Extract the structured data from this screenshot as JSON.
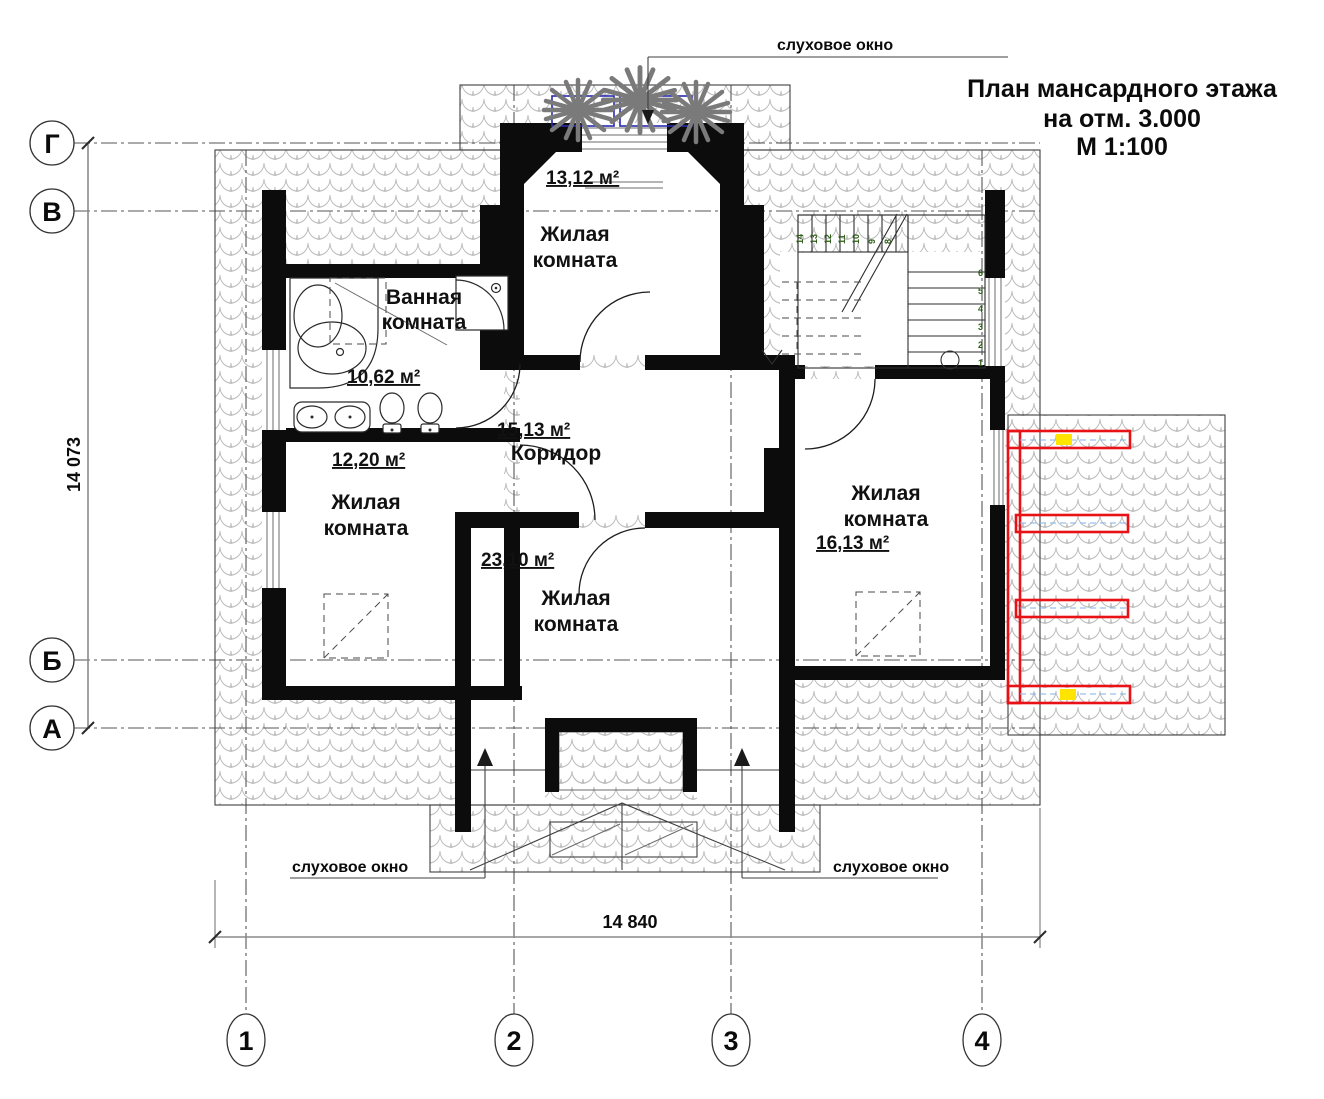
{
  "title": {
    "line1": "План мансардного этажа",
    "line2": "на отм. 3.000",
    "line3": "М 1:100"
  },
  "axes": {
    "horizontal": [
      "Г",
      "В",
      "Б",
      "А"
    ],
    "vertical": [
      "1",
      "2",
      "3",
      "4"
    ]
  },
  "dimensions": {
    "left_vertical": "14 073",
    "bottom_horizontal": "14 840"
  },
  "rooms": [
    {
      "name1": "Жилая",
      "name2": "комната",
      "area": "13,12 м²"
    },
    {
      "name1": "Ванная",
      "name2": "комната",
      "area": "10,62 м²"
    },
    {
      "name1": "Жилая",
      "name2": "комната",
      "area": "12,20 м²"
    },
    {
      "name1": "Коридор",
      "area": "15,13 м²"
    },
    {
      "name1": "Жилая",
      "name2": "комната",
      "area": "23,10 м²"
    },
    {
      "name1": "Жилая",
      "name2": "комната",
      "area": "16,13 м²"
    }
  ],
  "annotations": {
    "dormer_top": "слуховое окно",
    "dormer_bottom_left": "слуховое окно",
    "dormer_bottom_right": "слуховое окно"
  },
  "stairs": {
    "upper_numbers": [
      "14",
      "13",
      "12",
      "11",
      "10",
      "9",
      "8"
    ],
    "lower_numbers": [
      "6",
      "5",
      "4",
      "3",
      "2",
      "1"
    ]
  },
  "colors": {
    "wall": "#0c0c0c",
    "roof_hatch": "#b8b8b8",
    "railing_red": "#e81216",
    "highlight_yellow": "#ffe400",
    "planter_blue": "#2a2ab0",
    "stair_number_green": "#2f5d1a"
  }
}
